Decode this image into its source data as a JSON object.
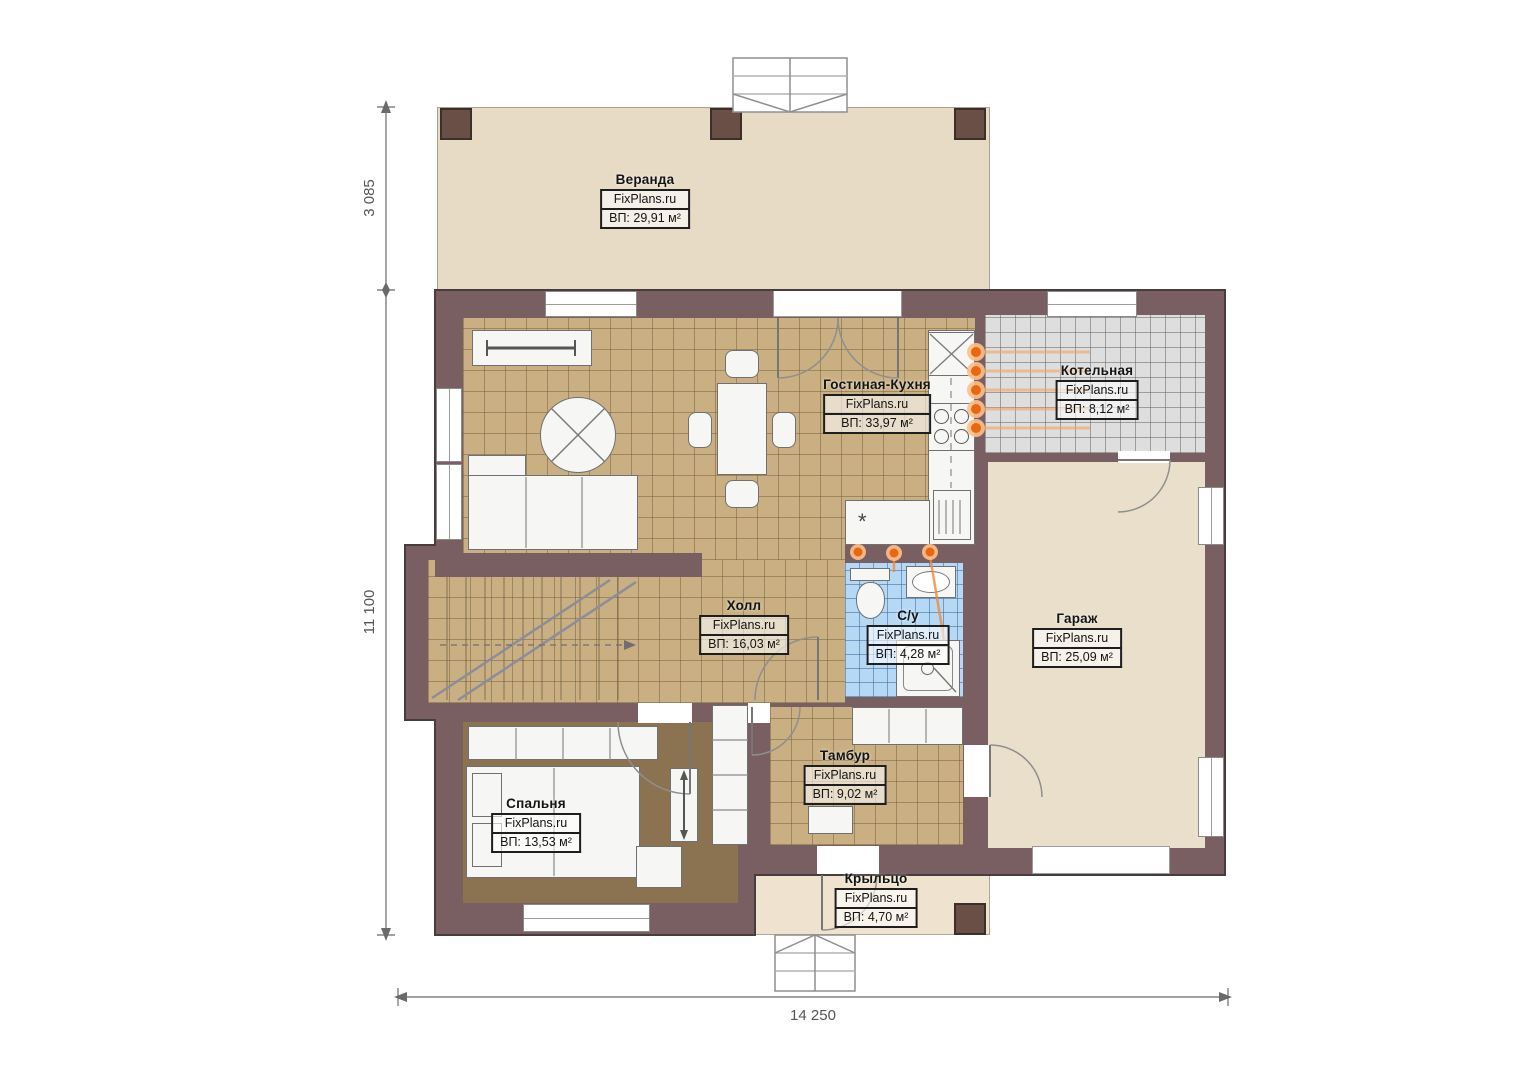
{
  "plan": {
    "watermark": "FixPlans.ru",
    "rooms": [
      {
        "name": "Веранда",
        "area": "ВП: 29,91 м²"
      },
      {
        "name": "Гостиная-Кухня",
        "area": "ВП: 33,97 м²"
      },
      {
        "name": "Котельная",
        "area": "ВП: 8,12 м²"
      },
      {
        "name": "Холл",
        "area": "ВП: 16,03 м²"
      },
      {
        "name": "С/у",
        "area": "ВП: 4,28 м²"
      },
      {
        "name": "Гараж",
        "area": "ВП: 25,09 м²"
      },
      {
        "name": "Тамбур",
        "area": "ВП: 9,02 м²"
      },
      {
        "name": "Спальня",
        "area": "ВП: 13,53 м²"
      },
      {
        "name": "Крыльцо",
        "area": "ВП: 4,70 м²"
      }
    ],
    "dimensions": {
      "veranda_depth": "3 085",
      "house_depth": "11 100",
      "house_width": "14 250"
    },
    "colors": {
      "wall": "#7a5f62",
      "tile_tan": "#c9af81",
      "tile_grey": "#dedede",
      "tile_blue": "#b5d9f5",
      "bedroom_floor": "#8b7251",
      "veranda_floor": "#e7dbc5",
      "garage_floor": "#e9dfca",
      "porch_floor": "#efe3cf",
      "heating_orange": "#f07820"
    }
  }
}
